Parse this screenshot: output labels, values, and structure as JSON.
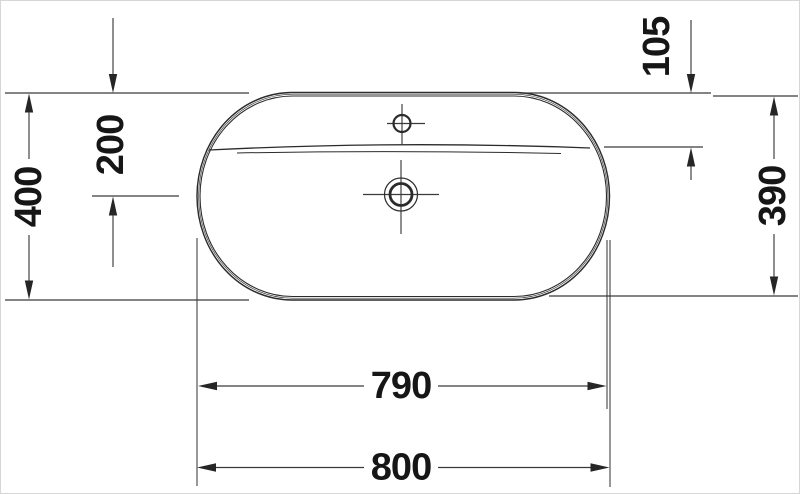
{
  "drawing": {
    "kind": "technical-dimension-drawing",
    "view": "washbasin-top-view"
  },
  "dimensions": {
    "depth_overall": "400",
    "drain_center_from_back": "200",
    "ledge_depth": "105",
    "depth_inner": "390",
    "width_inner": "790",
    "width_overall": "800"
  },
  "colors": {
    "background": "#ffffff",
    "page_border": "#d6d6d6",
    "outline": "#2b2b2b",
    "dimension_line": "#3a3a3a",
    "text": "#161616"
  }
}
